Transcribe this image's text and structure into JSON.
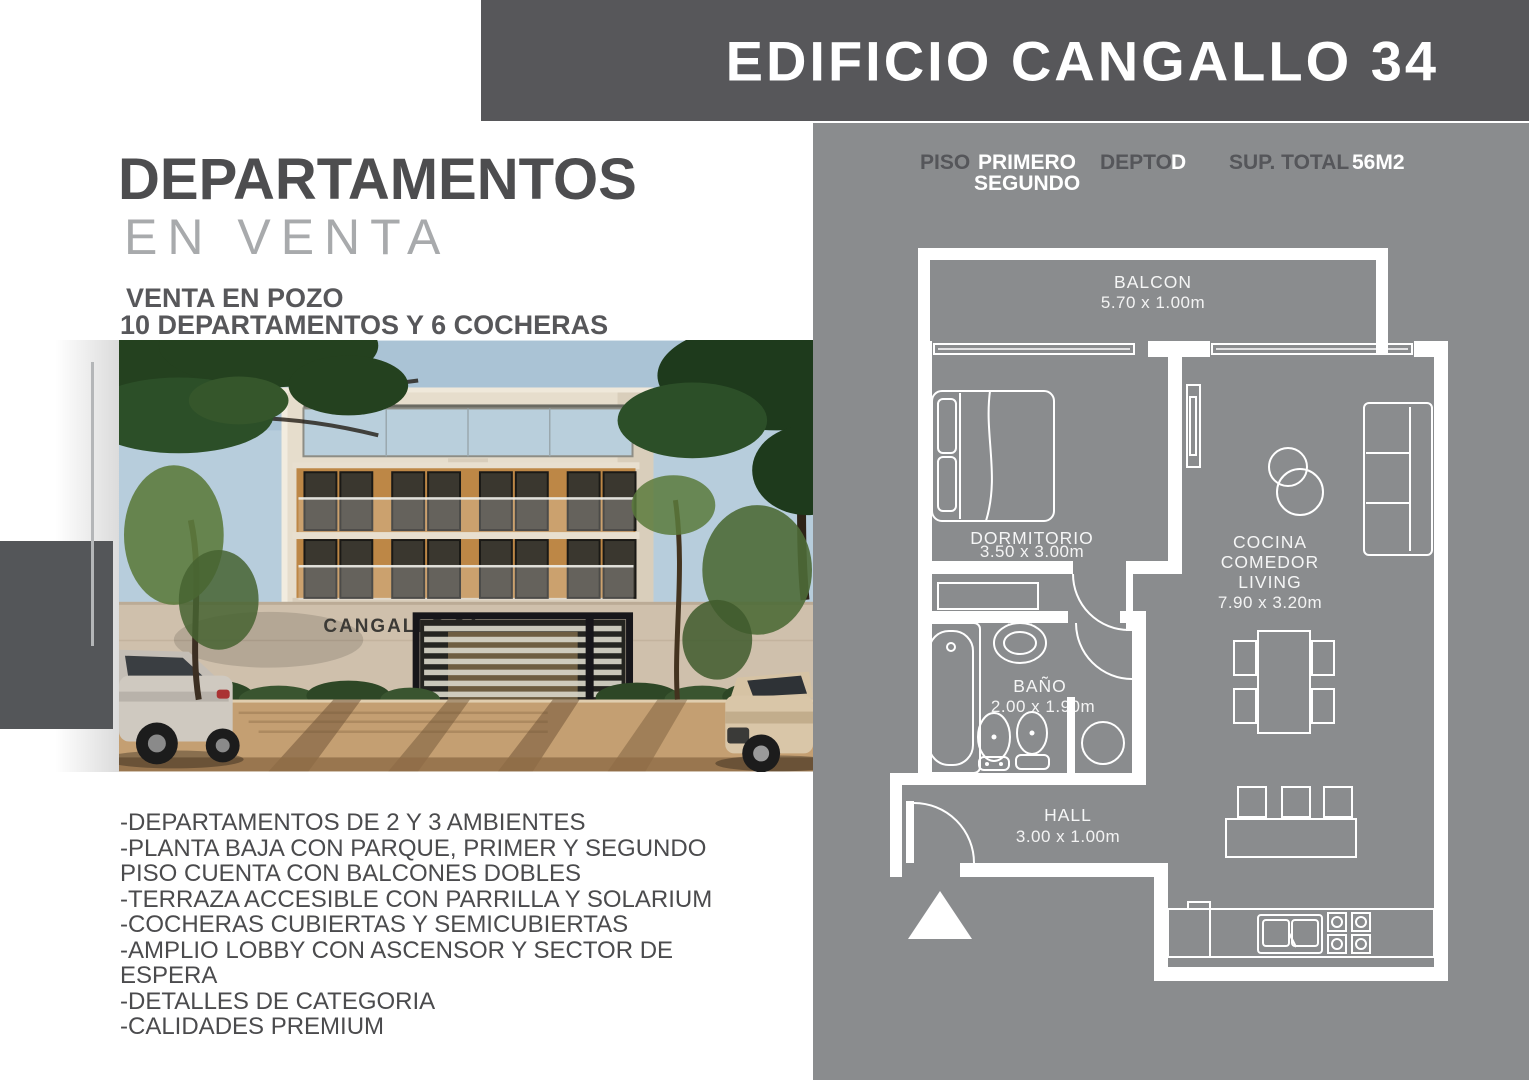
{
  "header": {
    "title": "EDIFICIO CANGALLO 34"
  },
  "left": {
    "title_line1": "DEPARTAMENTOS",
    "title_line2": "EN VENTA",
    "subtitle_line1": "VENTA EN POZO",
    "subtitle_line2": "10 DEPARTAMENTOS Y 6 COCHERAS",
    "photo": {
      "building_sign": "CANGALLO 34"
    },
    "features": [
      "-DEPARTAMENTOS DE 2 Y 3 AMBIENTES",
      "-PLANTA BAJA CON PARQUE, PRIMER Y SEGUNDO PISO CUENTA CON BALCONES DOBLES",
      "-TERRAZA ACCESIBLE CON PARRILLA Y SOLARIUM",
      "-COCHERAS CUBIERTAS Y SEMICUBIERTAS",
      "-AMPLIO LOBBY CON ASCENSOR Y SECTOR DE ESPERA",
      "-DETALLES DE CATEGORIA",
      "-CALIDADES PREMIUM"
    ]
  },
  "plan_info": {
    "piso_label": "PISO",
    "piso_value_line1": "PRIMERO",
    "piso_value_line2": "SEGUNDO",
    "depto_label": "DEPTO",
    "depto_value": "D",
    "sup_label": "SUP. TOTAL",
    "sup_value": "56M2"
  },
  "floor_plan": {
    "balcon": {
      "name": "BALCON",
      "size": "5.70 x 1.00m"
    },
    "dormitorio": {
      "name": "DORMITORIO",
      "size": "3.50 x 3.00m"
    },
    "cocina": {
      "name1": "COCINA",
      "name2": "COMEDOR",
      "name3": "LIVING",
      "size": "7.90 x 3.20m"
    },
    "bano": {
      "name": "BAÑO",
      "size": "2.00 x 1.90m"
    },
    "hall": {
      "name": "HALL",
      "size": "3.00 x 1.00m"
    }
  },
  "colors": {
    "header_bar": "#57575a",
    "panel_gray": "#8a8c8e",
    "plan_lines": "#ffffff",
    "title_dark": "#4d4d4f",
    "title_light": "#a8aaac",
    "accent_block": "#545659"
  }
}
